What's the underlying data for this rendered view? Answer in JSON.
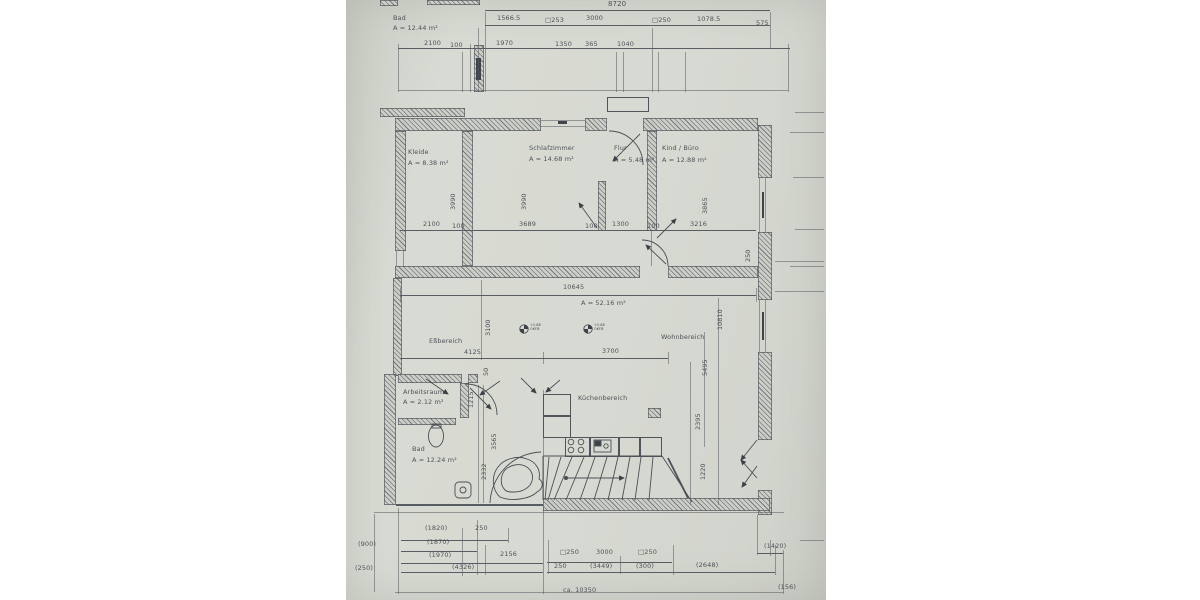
{
  "photo": {
    "paper": "#d7dad2",
    "ink": "#474c52"
  },
  "upper_plan": {
    "room_name": "Bad",
    "room_area": "A = 12.44 m²",
    "dim_total": "8720",
    "dims_row2": [
      "1566.5",
      "□253",
      "3000",
      "□250",
      "1078.5",
      "575"
    ],
    "dims_row3": [
      "2100",
      "100",
      "1970",
      "1350",
      "365",
      "1040"
    ]
  },
  "rooms": {
    "kleide_name": "Kleide",
    "kleide_area": "A = 8.38 m²",
    "schlaf_name": "Schlafzimmer",
    "schlaf_area": "A = 14.68 m²",
    "flur_name": "Flur",
    "flur_area": "A = 5.48 m²",
    "kind_name": "Kind / Büro",
    "kind_area": "A = 12.88 m²",
    "ess_name": "Eßbereich",
    "wohn_name": "Wohnbereich",
    "kueche_name": "Küchenbereich",
    "arbeit_name": "Arbeitsraum",
    "arbeit_area": "A = 2.12 m²",
    "bad_name": "Bad",
    "bad_area": "A = 12.24 m²",
    "living_area": "A = 52.16 m²"
  },
  "dims": {
    "rooms_bottom": [
      "2100",
      "100",
      "3689",
      "100",
      "1300",
      "100",
      "3216"
    ],
    "v_kleide": "3990",
    "v_schlaf": "3990",
    "v_kind": "3865",
    "v_wall": "250",
    "v_ess": "3100",
    "v_right": "10810",
    "v_mid": "5495",
    "v_small": "50",
    "v_arbeit": "1215",
    "v_bad1": "3565",
    "v_bad2": "2332",
    "v_kueche1": "2395",
    "v_kueche2": "1220",
    "living_width": "10645",
    "mid_row": [
      "4125",
      "3700"
    ],
    "bl_r1": [
      "(1820)",
      "250"
    ],
    "bl_r2": "(1870)",
    "bl_r3": [
      "(1970)",
      "2156"
    ],
    "bl_r4": "(4326)",
    "bl_edge1": "(900)",
    "bl_edge2": "(250)",
    "br_r1": [
      "□250",
      "3000",
      "□250"
    ],
    "br_r2": [
      "250",
      "(3449)",
      "(300)",
      "(2648)"
    ],
    "br_right": "(1420)",
    "br_corner": "(156)",
    "br_total": "ca. 10350"
  },
  "markers": {
    "l1": "+2.88",
    "l2": "OKFB"
  }
}
